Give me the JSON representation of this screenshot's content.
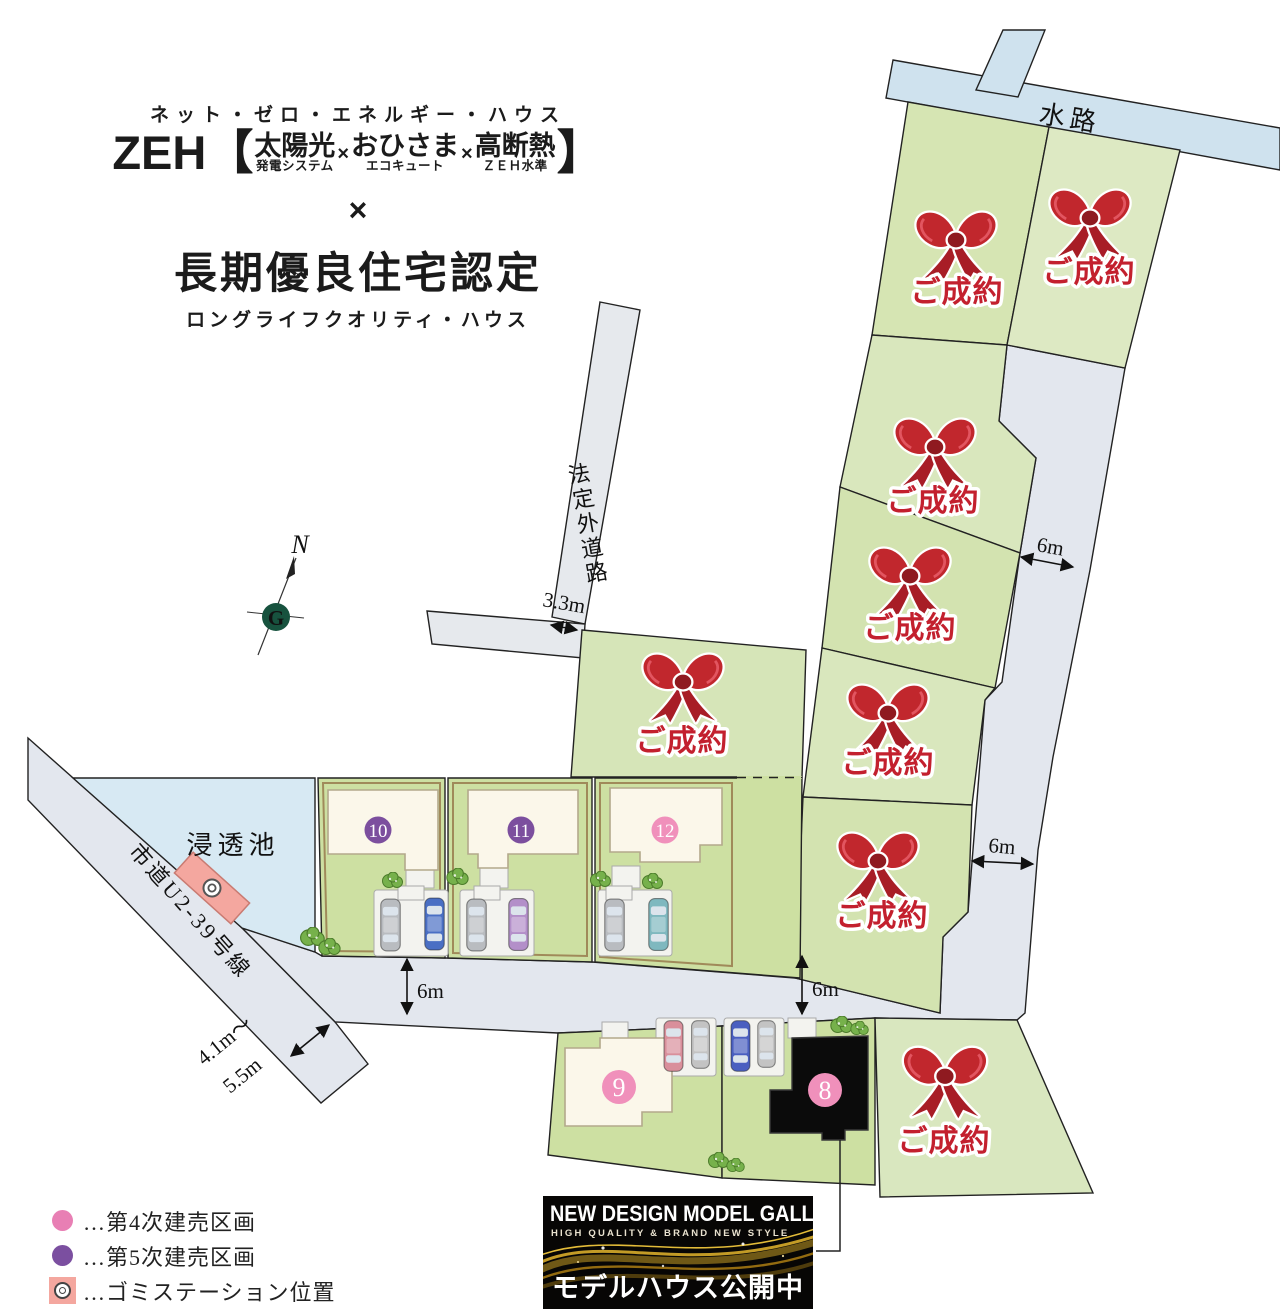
{
  "header": {
    "top_kana": "ネット・ゼロ・エネルギー・ハウス",
    "zeh": "ZEH",
    "bracket_open": "【",
    "bracket_close": "】",
    "cross": "×",
    "items": [
      {
        "main": "太陽光",
        "sub": "発電システム"
      },
      {
        "main": "おひさま",
        "sub": "エコキュート"
      },
      {
        "main": "高断熱",
        "sub": "ＺＥＨ水準"
      }
    ],
    "middle_cross": "×",
    "cert_title": "長期優良住宅認定",
    "cert_kana": "ロングライフクオリティ・ハウス"
  },
  "map": {
    "labels": {
      "waterway": "水路",
      "pond": "浸透池",
      "side_road": "法定外道路",
      "city_road": "市道U2-39号線",
      "sold": "ご成約",
      "north": "N",
      "logo_letter": "G"
    },
    "dims": {
      "d33": "3.3m",
      "d6": "6m",
      "d41": "4.1m〜",
      "d55": "5.5m"
    },
    "lots": {
      "n8": "8",
      "n9": "9",
      "n10": "10",
      "n11": "11",
      "n12": "12"
    }
  },
  "legend": {
    "items": [
      {
        "label": "…第4次建売区画"
      },
      {
        "label": "…第5次建売区画"
      },
      {
        "label": "…ゴミステーション位置"
      }
    ]
  },
  "banner": {
    "title": "NEW DESIGN MODEL GALLERY",
    "subtitle": "HIGH QUALITY & BRAND NEW STYLE",
    "cta": "モデルハウス公開中"
  },
  "colors": {
    "sold_red": "#c3202e",
    "phase4_pink": "#e87fb4",
    "phase5_purple": "#7b4fa0",
    "lot_green": "#d7e6bb",
    "house_lot_green": "#cde0a2",
    "road_gray": "#e3e7ee",
    "water_blue": "#cfe2ee",
    "banner_gold": "#c39b26"
  }
}
